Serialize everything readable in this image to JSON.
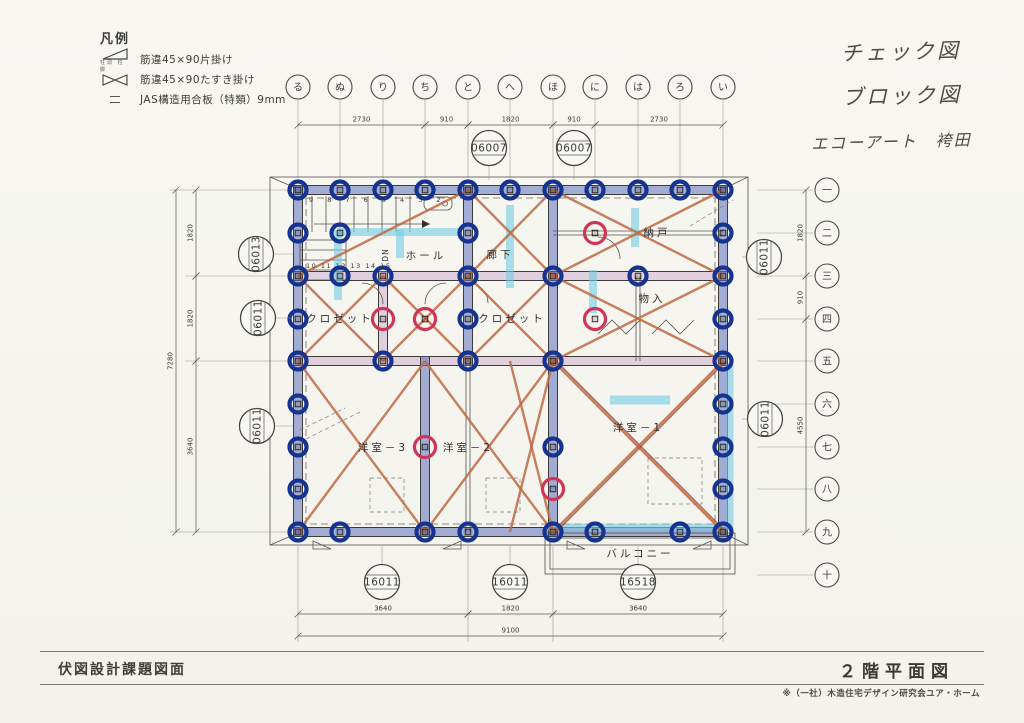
{
  "legend": {
    "title": "凡例",
    "items": [
      {
        "icon": "single-brace-triangle-icon",
        "label": "筋違45×90片掛け",
        "sublabel": "柱頭 柱脚"
      },
      {
        "icon": "cross-brace-bowtie-icon",
        "label": "筋違45×90たすき掛け"
      },
      {
        "icon": "dashed-line-icon",
        "label": "JAS構造用合板（特類）9mm"
      }
    ]
  },
  "handwritten": [
    "チェック図",
    "ブロック図",
    "エコーアート　袴田"
  ],
  "grid": {
    "column_labels": [
      "る",
      "ぬ",
      "り",
      "ち",
      "と",
      "へ",
      "ほ",
      "に",
      "は",
      "ろ",
      "い"
    ],
    "row_labels": [
      "一",
      "二",
      "三",
      "四",
      "五",
      "六",
      "七",
      "八",
      "九",
      "十"
    ]
  },
  "rooms": [
    {
      "label": "ホール",
      "x": 426,
      "y": 259
    },
    {
      "label": "納戸",
      "x": 657,
      "y": 236
    },
    {
      "label": "廊下",
      "x": 500,
      "y": 258
    },
    {
      "label": "クロゼット",
      "x": 340,
      "y": 322
    },
    {
      "label": "クロゼット",
      "x": 512,
      "y": 322
    },
    {
      "label": "物入",
      "x": 652,
      "y": 302
    },
    {
      "label": "洋室－3",
      "x": 383,
      "y": 451
    },
    {
      "label": "洋室－2",
      "x": 468,
      "y": 451
    },
    {
      "label": "洋室－1",
      "x": 638,
      "y": 431
    },
    {
      "label": "バルコニー",
      "x": 640,
      "y": 557
    }
  ],
  "stair_text": {
    "upper_numbers": "9 8 7 6 5 4 3 2",
    "lower_numbers": "10 11 12 13 14 15",
    "dn": "DN"
  },
  "footer": {
    "left_title": "伏図設計課題図面",
    "right_title": "２階平面図",
    "note": "※（一社）木造住宅デザイン研究会ユア・ホーム"
  },
  "colors": {
    "wall_marker_blue": "#566ABA",
    "joint_ring_navy": "#16338F",
    "check_ring_red": "#D23458",
    "brace_orange": "#BF6A44",
    "highlight_cyan": "#73CBE4",
    "wall_tint_pink": "#C196C4",
    "paper": "#F7F6F1"
  },
  "plan": {
    "cols": [
      298,
      340,
      383,
      425,
      468,
      510,
      553,
      595,
      638,
      680,
      723
    ],
    "rows": [
      190,
      233,
      276,
      319,
      361,
      404,
      447,
      489,
      532,
      575
    ],
    "bubble_row_y": 87,
    "bubble_col_x": 827,
    "eaves": [
      270,
      177,
      748,
      545
    ],
    "eaves_ties": [
      [
        270,
        177,
        296,
        188
      ],
      [
        748,
        177,
        725,
        188
      ],
      [
        270,
        545,
        296,
        534
      ],
      [
        748,
        545,
        725,
        534
      ]
    ],
    "jas_dash_rect": [
      306,
      198,
      409,
      326
    ],
    "walls_blue": [
      [
        0,
        0,
        10,
        0
      ],
      [
        0,
        8,
        10,
        8
      ],
      [
        0,
        0,
        0,
        8
      ],
      [
        10,
        0,
        10,
        8
      ],
      [
        4,
        0,
        4,
        4
      ],
      [
        6,
        0,
        6,
        8
      ],
      [
        3,
        4,
        3,
        8
      ]
    ],
    "walls_pink": [
      [
        0,
        2,
        10,
        2
      ],
      [
        0,
        4,
        10,
        4
      ],
      [
        2,
        2,
        2,
        4
      ]
    ],
    "walls_thin": [
      [
        6,
        1,
        10,
        1
      ],
      [
        8,
        2,
        8,
        4
      ],
      [
        4,
        4,
        4,
        8
      ]
    ],
    "braces": [
      [
        0,
        2,
        4,
        0
      ],
      [
        4,
        0,
        6,
        2
      ],
      [
        6,
        0,
        4,
        2
      ],
      [
        6,
        0,
        10,
        2
      ],
      [
        6,
        2,
        10,
        0
      ],
      [
        0,
        2,
        2,
        4
      ],
      [
        2,
        2,
        0,
        4
      ],
      [
        2,
        2,
        4,
        4
      ],
      [
        4,
        2,
        2,
        4
      ],
      [
        4,
        2,
        6,
        4
      ],
      [
        6,
        2,
        4,
        4
      ],
      [
        6,
        2,
        10,
        4
      ],
      [
        10,
        2,
        6,
        4
      ],
      [
        0,
        4,
        3,
        8
      ],
      [
        3,
        4,
        0,
        8
      ],
      [
        3,
        4,
        6,
        8
      ],
      [
        6,
        4,
        3,
        8
      ],
      [
        5,
        4,
        6,
        8
      ],
      [
        6,
        4,
        5,
        8
      ]
    ],
    "braces_double": [
      [
        6,
        4,
        10,
        8
      ],
      [
        10,
        4,
        6,
        8
      ]
    ],
    "joints": [
      [
        0,
        0
      ],
      [
        1,
        0
      ],
      [
        2,
        0
      ],
      [
        3,
        0
      ],
      [
        4,
        0
      ],
      [
        5,
        0
      ],
      [
        6,
        0
      ],
      [
        7,
        0
      ],
      [
        8,
        0
      ],
      [
        9,
        0
      ],
      [
        10,
        0
      ],
      [
        0,
        8
      ],
      [
        1,
        8
      ],
      [
        3,
        8
      ],
      [
        4,
        8
      ],
      [
        6,
        8
      ],
      [
        7,
        8
      ],
      [
        9,
        8
      ],
      [
        10,
        8
      ],
      [
        0,
        1
      ],
      [
        0,
        2
      ],
      [
        0,
        3
      ],
      [
        0,
        4
      ],
      [
        0,
        5
      ],
      [
        0,
        6
      ],
      [
        0,
        7
      ],
      [
        10,
        1
      ],
      [
        10,
        2
      ],
      [
        10,
        3
      ],
      [
        10,
        4
      ],
      [
        10,
        5
      ],
      [
        10,
        6
      ],
      [
        10,
        7
      ],
      [
        4,
        1
      ],
      [
        4,
        2
      ],
      [
        4,
        3
      ],
      [
        4,
        4
      ],
      [
        6,
        2
      ],
      [
        6,
        4
      ],
      [
        6,
        6
      ],
      [
        1,
        1
      ],
      [
        1,
        2
      ],
      [
        2,
        2
      ],
      [
        2,
        4
      ],
      [
        8,
        2
      ]
    ],
    "red_rings": [
      [
        2,
        3
      ],
      [
        3,
        3
      ],
      [
        7,
        1
      ],
      [
        7,
        3
      ],
      [
        3,
        6
      ],
      [
        6,
        7
      ]
    ],
    "cyan": [
      [
        338,
        230,
        338,
        300,
        8
      ],
      [
        337,
        232,
        462,
        232,
        8
      ],
      [
        400,
        230,
        400,
        258,
        8
      ],
      [
        510,
        205,
        510,
        288,
        8
      ],
      [
        593,
        270,
        593,
        313,
        8
      ],
      [
        635,
        208,
        635,
        247,
        8
      ],
      [
        610,
        400,
        670,
        400,
        9
      ],
      [
        548,
        527,
        731,
        527,
        7
      ],
      [
        730,
        365,
        730,
        528,
        7
      ]
    ],
    "dim_top": {
      "y": 125,
      "segs": [
        {
          "a": 0,
          "b": 3,
          "t": "2730"
        },
        {
          "a": 3,
          "b": 4,
          "t": "910"
        },
        {
          "a": 4,
          "b": 6,
          "t": "1820"
        },
        {
          "a": 6,
          "b": 7,
          "t": "910"
        },
        {
          "a": 7,
          "b": 10,
          "t": "2730"
        }
      ]
    },
    "dim_bottom": {
      "y": 614,
      "segs": [
        {
          "a": 0,
          "b": 4,
          "t": "3640"
        },
        {
          "a": 4,
          "b": 6,
          "t": "1820"
        },
        {
          "a": 6,
          "b": 10,
          "t": "3640"
        }
      ]
    },
    "dim_bottom_total": {
      "y": 636,
      "t": "9100"
    },
    "dim_left": {
      "x": 196,
      "segs": [
        {
          "a": 0,
          "b": 2,
          "t": "1820"
        },
        {
          "a": 2,
          "b": 4,
          "t": "1820"
        },
        {
          "a": 4,
          "b": 8,
          "t": "3640"
        }
      ]
    },
    "dim_left_total": {
      "x": 176,
      "t": "7280"
    },
    "dim_right": {
      "x": 806,
      "segs": [
        {
          "a": 0,
          "b": 2,
          "t": "1820"
        },
        {
          "a": 2,
          "b": 3,
          "t": "910"
        },
        {
          "a": 3,
          "b": 8,
          "t": "4550"
        }
      ]
    },
    "code_bubbles": [
      {
        "label": "06007",
        "x": 489,
        "y": 148,
        "rot": 0,
        "dir": "down"
      },
      {
        "label": "06007",
        "x": 574,
        "y": 148,
        "rot": 0,
        "dir": "down"
      },
      {
        "label": "06013",
        "x": 256,
        "y": 254,
        "rot": -90,
        "dir": "right"
      },
      {
        "label": "06011",
        "x": 258,
        "y": 318,
        "rot": -90,
        "dir": "right"
      },
      {
        "label": "06011",
        "x": 257,
        "y": 426,
        "rot": -90,
        "dir": "right"
      },
      {
        "label": "06011",
        "x": 764,
        "y": 257,
        "rot": -90,
        "dir": "left"
      },
      {
        "label": "06011",
        "x": 765,
        "y": 419,
        "rot": -90,
        "dir": "left"
      },
      {
        "label": "16011",
        "x": 382,
        "y": 582,
        "rot": 0,
        "dir": "up"
      },
      {
        "label": "16011",
        "x": 510,
        "y": 582,
        "rot": 0,
        "dir": "up"
      },
      {
        "label": "16518",
        "x": 638,
        "y": 582,
        "rot": 0,
        "dir": "up"
      }
    ],
    "stair": {
      "treads_x": [
        312,
        326,
        340,
        354,
        368,
        382,
        396,
        410
      ],
      "y1": 196,
      "y2": 232,
      "arrow": [
        314,
        224,
        430,
        224
      ],
      "upper_x": 309,
      "upper_y": 202,
      "lower_x": 306,
      "lower_y": 268,
      "dn_x": 388,
      "dn_y": 255,
      "lower_box": [
        300,
        240,
        46,
        40
      ]
    },
    "fixture": [
      424,
      197,
      28,
      13
    ],
    "arcs": [
      "M 362,283 A 21 21 0 0 1 383,304",
      "M 446,283 A 21 21 0 0 0 425,304",
      "M 598,237 A 22 22 0 0 1 620,259",
      "M 468,283 A 20 20 0 0 1 488,303"
    ],
    "dashed_rects": [
      [
        370,
        478,
        34,
        34
      ],
      [
        486,
        478,
        34,
        34
      ],
      [
        648,
        458,
        54,
        46
      ]
    ],
    "hatch_dashed": [
      [
        300,
        430,
        345,
        408
      ],
      [
        300,
        442,
        360,
        412
      ],
      [
        690,
        226,
        733,
        200
      ]
    ],
    "zigzags": [
      [
        598,
        334,
        612,
        320,
        626,
        334,
        640,
        320
      ],
      [
        652,
        334,
        666,
        320,
        680,
        334,
        694,
        320
      ]
    ],
    "triangles": [
      [
        313,
        549,
        1
      ],
      [
        443,
        549,
        -1
      ],
      [
        567,
        549,
        1
      ],
      [
        693,
        549,
        -1
      ]
    ],
    "balcony": {
      "outer": [
        545,
        533,
        190,
        41
      ],
      "inner": [
        550,
        538,
        180,
        31
      ]
    }
  }
}
